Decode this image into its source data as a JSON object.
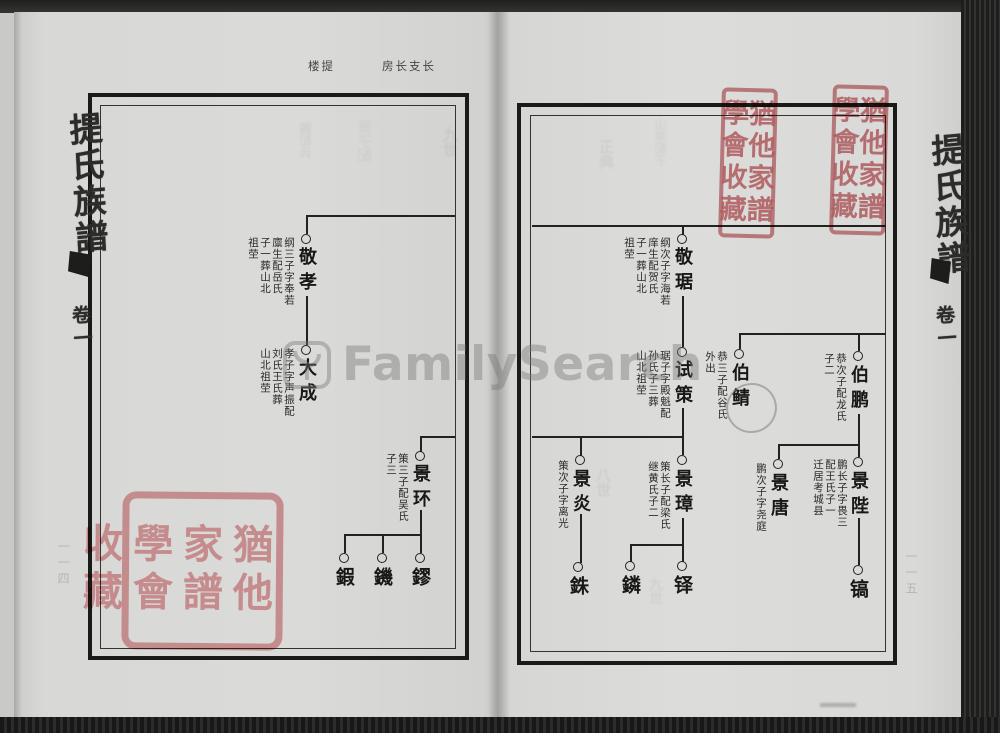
{
  "page_header": {
    "left_label": "楼提",
    "right_label": "房长支长"
  },
  "spine_left": {
    "title": "提氏族譜",
    "volume": "卷一"
  },
  "spine_right": {
    "title": "提氏族譜",
    "volume": "卷一"
  },
  "margin_numbers": {
    "left": "一一四",
    "right": "一一五"
  },
  "watermark": {
    "text": "FamilySearch"
  },
  "seals": {
    "tall_seal_text": "猶他家譜學會收藏",
    "square_seal_text": "猶他家譜學會收藏"
  },
  "left_chart": {
    "nodes": [
      {
        "name": "敬孝",
        "note": "纲三子字奉若\n廪生配岳氏\n子一葬山北\n祖茔"
      },
      {
        "name": "大成",
        "note": "孝子字声振配\n刘氏王氏葬\n山北祖茔"
      },
      {
        "name": "景环",
        "note": "策三子配吴氏\n子三"
      },
      {
        "name": "鍜"
      },
      {
        "name": "鐖"
      },
      {
        "name": "鏐"
      }
    ]
  },
  "right_chart": {
    "nodes": [
      {
        "name": "敬琚",
        "note": "纲次子字海若\n庠生配贺氏\n子一葬山北\n祖茔"
      },
      {
        "name": "试策",
        "note": "琚子字殿魁配\n孙氏子三葬\n山北祖茔"
      },
      {
        "name": "景炎",
        "note": "策次子字离光"
      },
      {
        "name": "景璋",
        "note": "策长子配梁氏\n继黄氏子二"
      },
      {
        "name": "銖"
      },
      {
        "name": "鏻"
      },
      {
        "name": "铎"
      },
      {
        "name": "伯鲭",
        "note": "恭三子配谷氏\n外出"
      },
      {
        "name": "伯鹏",
        "note": "恭次子配龙氏\n子二"
      },
      {
        "name": "景唐",
        "note": "鹏次子字尧庭"
      },
      {
        "name": "景陛",
        "note": "鹏长子字畏三\n配王氏子一\n迁居考城县"
      },
      {
        "name": "镐"
      }
    ]
  },
  "ghosts_left": [
    "九世",
    "鵬配氏",
    "景子配"
  ],
  "ghosts_right": [
    "正典",
    "山東配子",
    "八世",
    "九世"
  ],
  "colors": {
    "seal_red": "#cb696e",
    "paper": "#d9d9d7",
    "ink": "#22221f",
    "watermark_gray": "#767676"
  }
}
